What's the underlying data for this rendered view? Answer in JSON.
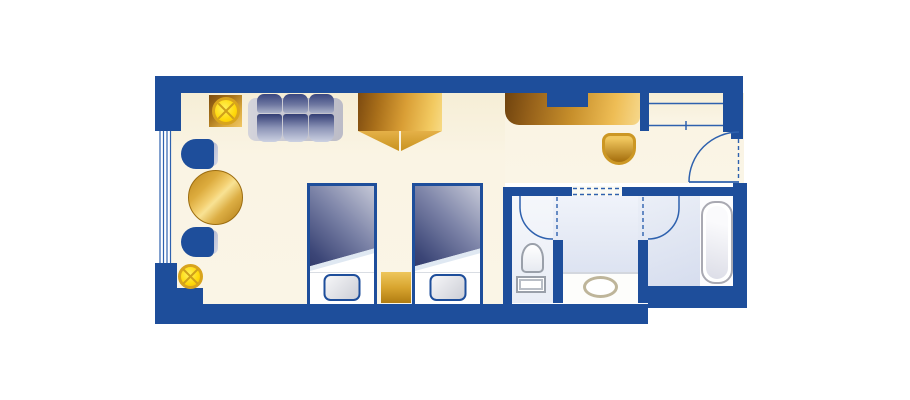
{
  "palette": {
    "wall": "#1e4e9b",
    "floor": "#faf4e4",
    "line": "#2e61ae",
    "yellow": "#ffd90a",
    "duvetDark": "#1d2656",
    "duvetLight": "#c5c8d7",
    "goldDark": "#7d4c0e",
    "goldLight": "#f2ca63",
    "bathFloor": "#e3e9f4",
    "fixtureBorder": "#9aa0aa",
    "sinkRing": "#beb59a"
  },
  "plan": {
    "kind": "hotel-guest-room-floor-plan",
    "rooms": [
      {
        "name": "bedroom"
      },
      {
        "name": "closet"
      },
      {
        "name": "entry-hall"
      },
      {
        "name": "toilet-room"
      },
      {
        "name": "vanity-area"
      },
      {
        "name": "shower-and-tub-room"
      }
    ],
    "furniture": [
      {
        "name": "side-table-with-lamp"
      },
      {
        "name": "sofa-three-seat"
      },
      {
        "name": "lounge-chair-gold"
      },
      {
        "name": "tv-desk-cabinet"
      },
      {
        "name": "desk-stool"
      },
      {
        "name": "closet-shelves-with-rod"
      },
      {
        "name": "entrance-door"
      },
      {
        "name": "window-armchair"
      },
      {
        "name": "window-armchair"
      },
      {
        "name": "round-table"
      },
      {
        "name": "floor-lamp"
      },
      {
        "name": "twin-bed"
      },
      {
        "name": "twin-bed"
      },
      {
        "name": "nightstand"
      },
      {
        "name": "toilet"
      },
      {
        "name": "vanity-counter-with-sink"
      },
      {
        "name": "bathtub"
      }
    ]
  }
}
